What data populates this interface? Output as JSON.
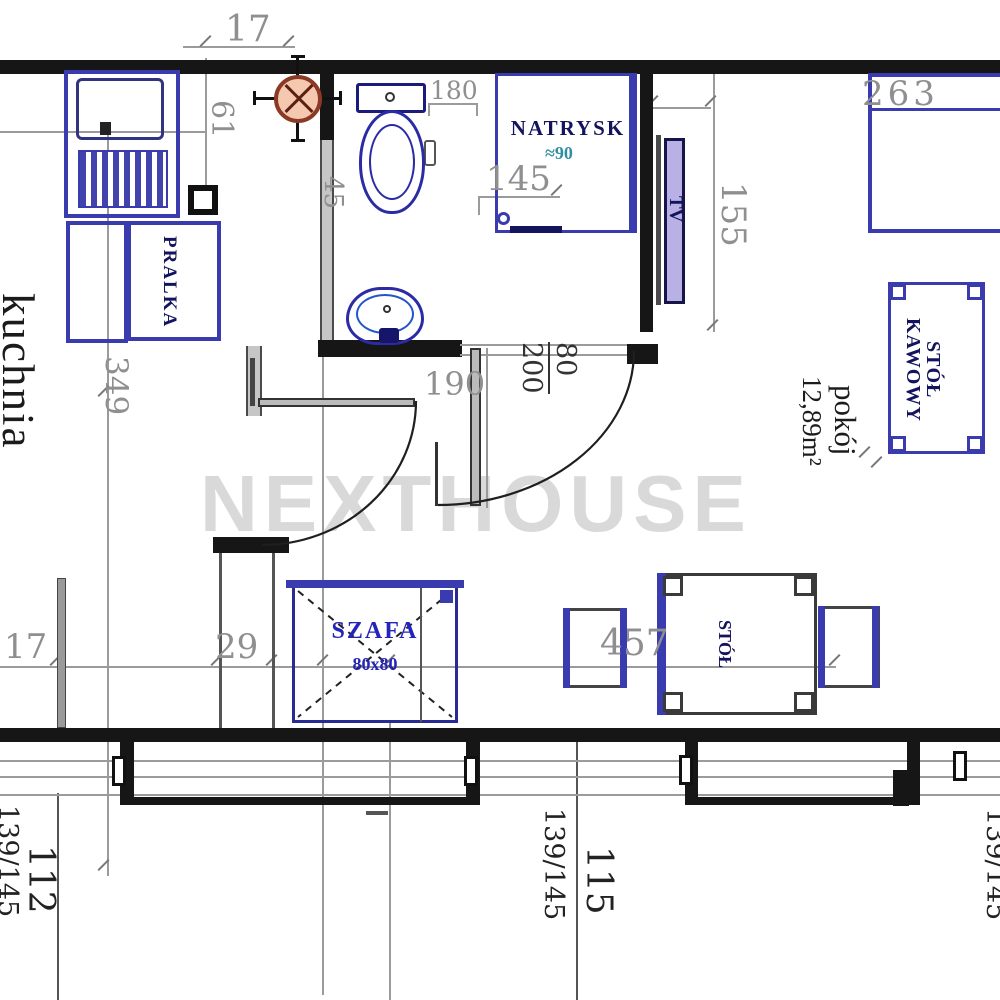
{
  "watermark": "NEXTHOUSE",
  "labels": {
    "kitchen": "kuchnia",
    "room": "pokój",
    "room_area": "12,89m²",
    "washer": "PRALKA",
    "shower": "NATRYSK",
    "shower_size": "≈90",
    "tv": "TV",
    "coffee_table_line1": "STÓŁ",
    "coffee_table_line2": "KAWOWY",
    "wardrobe": "SZAFA",
    "wardrobe_size": "80x80",
    "table": "STÓŁ"
  },
  "dims": {
    "d17_top": "17",
    "d61": "61",
    "d180": "180",
    "d45": "45",
    "d145": "145",
    "d263": "263",
    "d155": "155",
    "d190": "190",
    "door_w": "80",
    "door_h": "200",
    "d349": "349",
    "d17_bottom": "17",
    "d29": "29",
    "d457": "457",
    "win_left_w": "112",
    "win_left_spec": "139/145",
    "win_mid_w": "115",
    "win_mid_spec": "139/145",
    "win_right_spec": "139/145"
  },
  "colors": {
    "furniture_blue": "#3b3bb0",
    "label_navy": "#14145e",
    "wardrobe_text_blue": "#2424bb",
    "dim_gray": "#8f8f8f",
    "dark_dim_text": "#222222",
    "symbol_red_stroke": "#8b3a25",
    "symbol_red_fill": "#f4c9b0",
    "shower_size_teal": "#2f8fa0",
    "tv_fill": "#b9b0e6",
    "watermark_gray": "#d9d9d9",
    "wall_black": "#161616"
  }
}
